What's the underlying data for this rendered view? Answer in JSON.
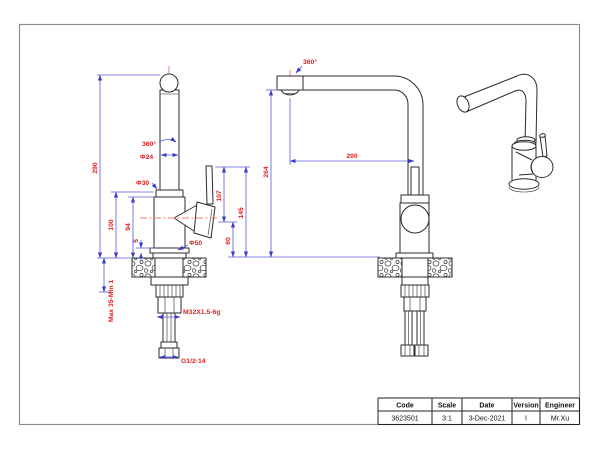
{
  "front_view": {
    "dims": {
      "total_height": "290",
      "swivel": "360°",
      "pipe_dia": "Φ24",
      "neck_dia": "Φ30",
      "body_top_height": "100",
      "body_height": "94",
      "flange_height": "5",
      "base_dia": "Φ50",
      "handle_top_to_center": "107",
      "handle_top_height": "145",
      "center_height": "60",
      "mount_thickness": "Max 35-Min 1",
      "shank_thread": "M32X1.5-6g",
      "hose_thread": "G1/2-14"
    }
  },
  "side_view": {
    "dims": {
      "swivel": "360°",
      "spout_reach": "200",
      "spout_height": "264"
    }
  },
  "title_block": {
    "headers": [
      "Code",
      "Scale",
      "Date",
      "Version",
      "Engineer"
    ],
    "values": [
      "3623501",
      "3:1",
      "3-Dec-2021",
      "I",
      "Mr.Xu"
    ]
  },
  "colors": {
    "dimension_line": "#5a5ade",
    "dimension_text": "#e01f1f",
    "centerline": "#ef7b7b",
    "drawing_line": "#2b2b2b"
  }
}
